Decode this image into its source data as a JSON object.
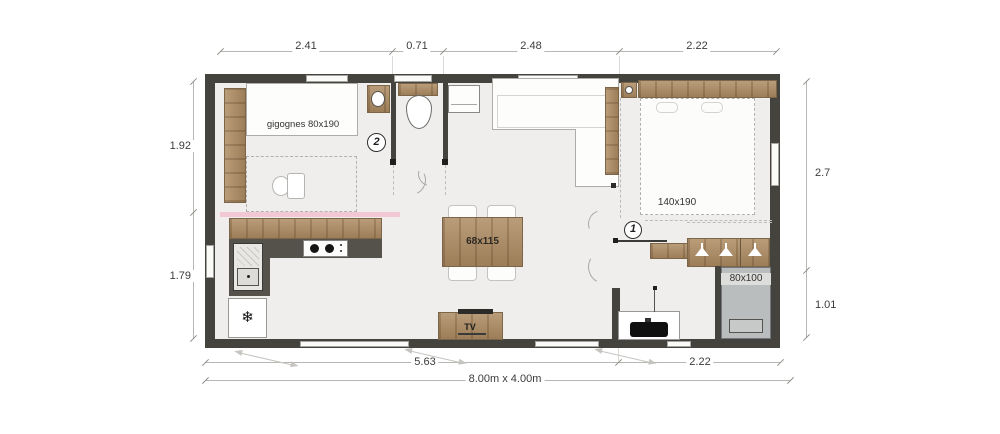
{
  "plan_labels": {
    "bed2_label": "gigognes 80x190",
    "bed1_label": "140x190",
    "table_label": "68x115",
    "shower_label": "80x100",
    "tv_label": "TV",
    "marker_bedroom1": "1",
    "marker_bedroom2": "2",
    "fridge_icon": "❄"
  },
  "dimensions": {
    "top": [
      "2.41",
      "0.71",
      "2.48",
      "2.22"
    ],
    "left": [
      "1.92",
      "1.79"
    ],
    "right": [
      "2.7",
      "1.01"
    ],
    "bottom": [
      "5.63",
      "2.22"
    ],
    "overall": "8.00m x 4.00m"
  },
  "colors": {
    "wall": "#45433e",
    "wood": "#ae8c63",
    "counter": "#55524c",
    "floor": "#efeeec",
    "accent_pink": "#f3c8d5",
    "shower_gray": "#b9bdbe"
  }
}
